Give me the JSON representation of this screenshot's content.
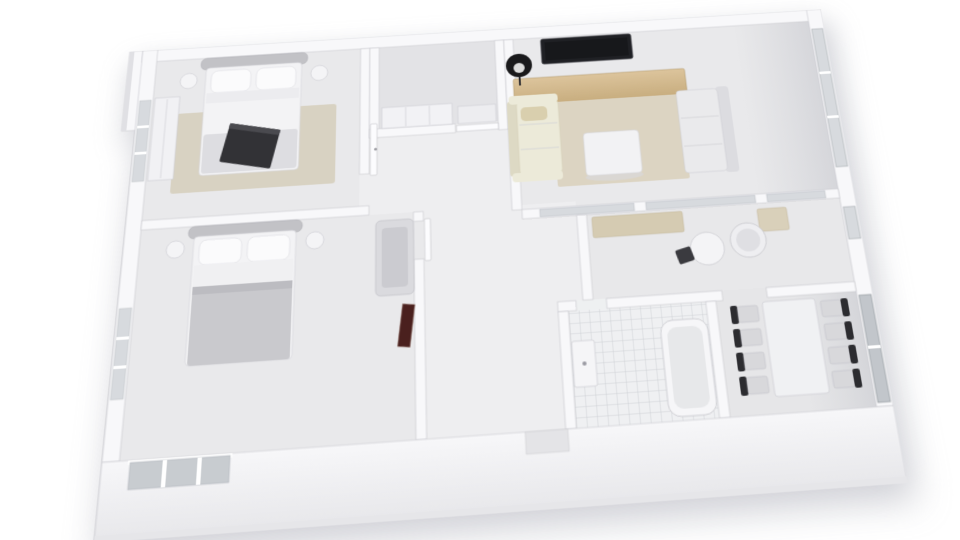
{
  "scene": {
    "type": "3d-floorplan-render",
    "description": "white-architectural-model-apartment-top-down-perspective"
  },
  "rooms": [
    {
      "name": "bedroom-top-left"
    },
    {
      "name": "bedroom-mid-left"
    },
    {
      "name": "storage-closet-top-center"
    },
    {
      "name": "hallway-center"
    },
    {
      "name": "living-room-top-right"
    },
    {
      "name": "kitchen-nook-right"
    },
    {
      "name": "dining-room-bottom-right"
    },
    {
      "name": "bathroom-bottom-center"
    }
  ],
  "furniture": [
    "double-bed-1",
    "double-bed-2",
    "nightstands",
    "wardrobe",
    "armchair",
    "leaning-mirror",
    "tv",
    "floor-lamp",
    "wood-sideboard",
    "cream-sofa",
    "white-sofa",
    "coffee-table",
    "area-rug",
    "round-table",
    "cylinder-basin",
    "counters",
    "dining-table",
    "eight-dining-chairs",
    "bathtub",
    "vanity-sink",
    "tiled-floor",
    "windows",
    "doors"
  ],
  "colors": {
    "background": "#ffffff",
    "floor_room": "#e9e9eb",
    "floor_hall": "#eeeef0",
    "floor_storage": "#e3e3e6",
    "floor_kitchen": "#e8e8ea",
    "floor_dining": "#e6e6e8",
    "rug_living": "#dcd4c2",
    "rug_bedroom": "#d8d2c2",
    "wood_dark": "#bfa477",
    "sofa_cream": "#ecead9",
    "sofa_cream_shade": "#ddd9c4",
    "sofa_white": "#eaeaec",
    "bed_blanket": "#c9c9cd",
    "bed_blanket_light": "#dddde1",
    "headboard": "#c2c2c6",
    "dark_object": "#323236",
    "tv": "#1f2024",
    "lamp": "#19191b",
    "chair_dark": "#2c2c30",
    "chair_light": "#d8d8db",
    "table_white": "#f0f1f3",
    "glass": "#d7dade",
    "glass_dark": "#c2c6cb",
    "counter": "#d5cbb2",
    "counter_light": "#d9d0ba",
    "accent_red": "#4a201e",
    "tan_pillow": "#d9cfae"
  }
}
